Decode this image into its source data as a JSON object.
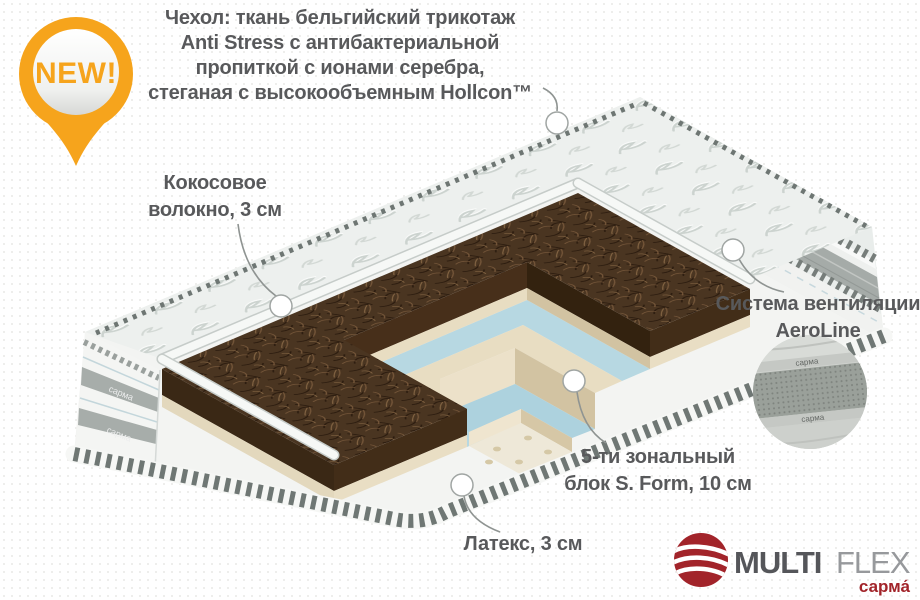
{
  "badge": {
    "label": "NEW!"
  },
  "callouts": {
    "cover": "Чехол: ткань бельгийский трикотаж\nAnti Stress с антибактериальной\nпропиткой с ионами серебра,\nстеганая с высокообъемным Hollcon™",
    "coconut": "Кокосовое\nволокно, 3 см",
    "ventilation": "Система вентиляции\nAeroLine",
    "sform": "5-ти зональный\nблок S. Form, 10 см",
    "latex": "Латекс, 3 см"
  },
  "logo": {
    "brand_primary": "MULTI",
    "brand_secondary": "FLEX",
    "sub_brand": "сарма́"
  },
  "mattress": {
    "side_tape_label": "сарма"
  },
  "colors": {
    "accent_orange": "#F6A41C",
    "label_text": "#58595B",
    "logo_red": "#A2242A",
    "coconut_brown": "#4A3421",
    "foam_blue": "#B7D8E2",
    "foam_beige": "#E8DDC2"
  }
}
